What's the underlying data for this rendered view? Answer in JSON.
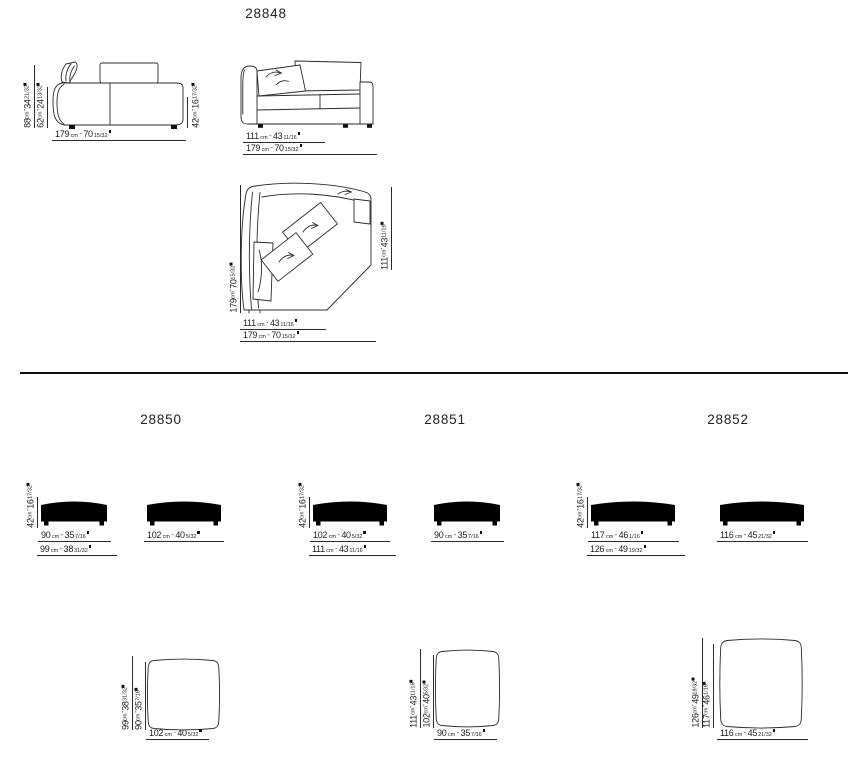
{
  "units": {
    "cm_label": "cm",
    "separator": "-"
  },
  "m28848": {
    "code": "28848",
    "front": {
      "h_total": {
        "cm": "88",
        "in": "34",
        "fr": "21/32"
      },
      "h_back": {
        "cm": "62",
        "in": "24",
        "fr": "13/32"
      },
      "h_seat": {
        "cm": "42",
        "in": "16",
        "fr": "17/32"
      },
      "width": {
        "cm": "179",
        "in": "70",
        "fr": "15/32"
      }
    },
    "corner": {
      "depth": {
        "cm": "111",
        "in": "43",
        "fr": "11/16"
      },
      "width": {
        "cm": "179",
        "in": "70",
        "fr": "15/32"
      }
    },
    "plan": {
      "left": {
        "cm": "179",
        "in": "70",
        "fr": "15/32"
      },
      "right": {
        "cm": "111",
        "in": "43",
        "fr": "11/16"
      },
      "bottom_a": {
        "cm": "111",
        "in": "43",
        "fr": "11/16"
      },
      "bottom_b": {
        "cm": "179",
        "in": "70",
        "fr": "15/32"
      }
    }
  },
  "m28850": {
    "code": "28850",
    "h_seat": {
      "cm": "42",
      "in": "16",
      "fr": "17/32"
    },
    "ottoman_a": {
      "w_seat": {
        "cm": "90",
        "in": "35",
        "fr": "7/16"
      },
      "w_total": {
        "cm": "99",
        "in": "38",
        "fr": "31/32"
      }
    },
    "ottoman_b": {
      "width": {
        "cm": "102",
        "in": "40",
        "fr": "5/32"
      }
    },
    "plan": {
      "d_outer": {
        "cm": "99",
        "in": "38",
        "fr": "31/32"
      },
      "d_inner": {
        "cm": "90",
        "in": "35",
        "fr": "7/16"
      },
      "width": {
        "cm": "102",
        "in": "40",
        "fr": "5/32"
      }
    }
  },
  "m28851": {
    "code": "28851",
    "h_seat": {
      "cm": "42",
      "in": "16",
      "fr": "17/32"
    },
    "ottoman_a": {
      "w_seat": {
        "cm": "102",
        "in": "40",
        "fr": "5/32"
      },
      "w_total": {
        "cm": "111",
        "in": "43",
        "fr": "11/16"
      }
    },
    "ottoman_b": {
      "width": {
        "cm": "90",
        "in": "35",
        "fr": "7/16"
      }
    },
    "plan": {
      "d_outer": {
        "cm": "111",
        "in": "43",
        "fr": "11/16"
      },
      "d_inner": {
        "cm": "102",
        "in": "40",
        "fr": "5/32"
      },
      "width": {
        "cm": "90",
        "in": "35",
        "fr": "7/16"
      }
    }
  },
  "m28852": {
    "code": "28852",
    "h_seat": {
      "cm": "42",
      "in": "16",
      "fr": "17/32"
    },
    "ottoman_a": {
      "w_seat": {
        "cm": "117",
        "in": "46",
        "fr": "1/16"
      },
      "w_total": {
        "cm": "126",
        "in": "49",
        "fr": "19/32"
      }
    },
    "ottoman_b": {
      "width": {
        "cm": "116",
        "in": "45",
        "fr": "21/32"
      }
    },
    "plan": {
      "d_outer": {
        "cm": "126",
        "in": "49",
        "fr": "19/32"
      },
      "d_inner": {
        "cm": "117",
        "in": "46",
        "fr": "1/16"
      },
      "width": {
        "cm": "116",
        "in": "45",
        "fr": "21/32"
      }
    }
  }
}
